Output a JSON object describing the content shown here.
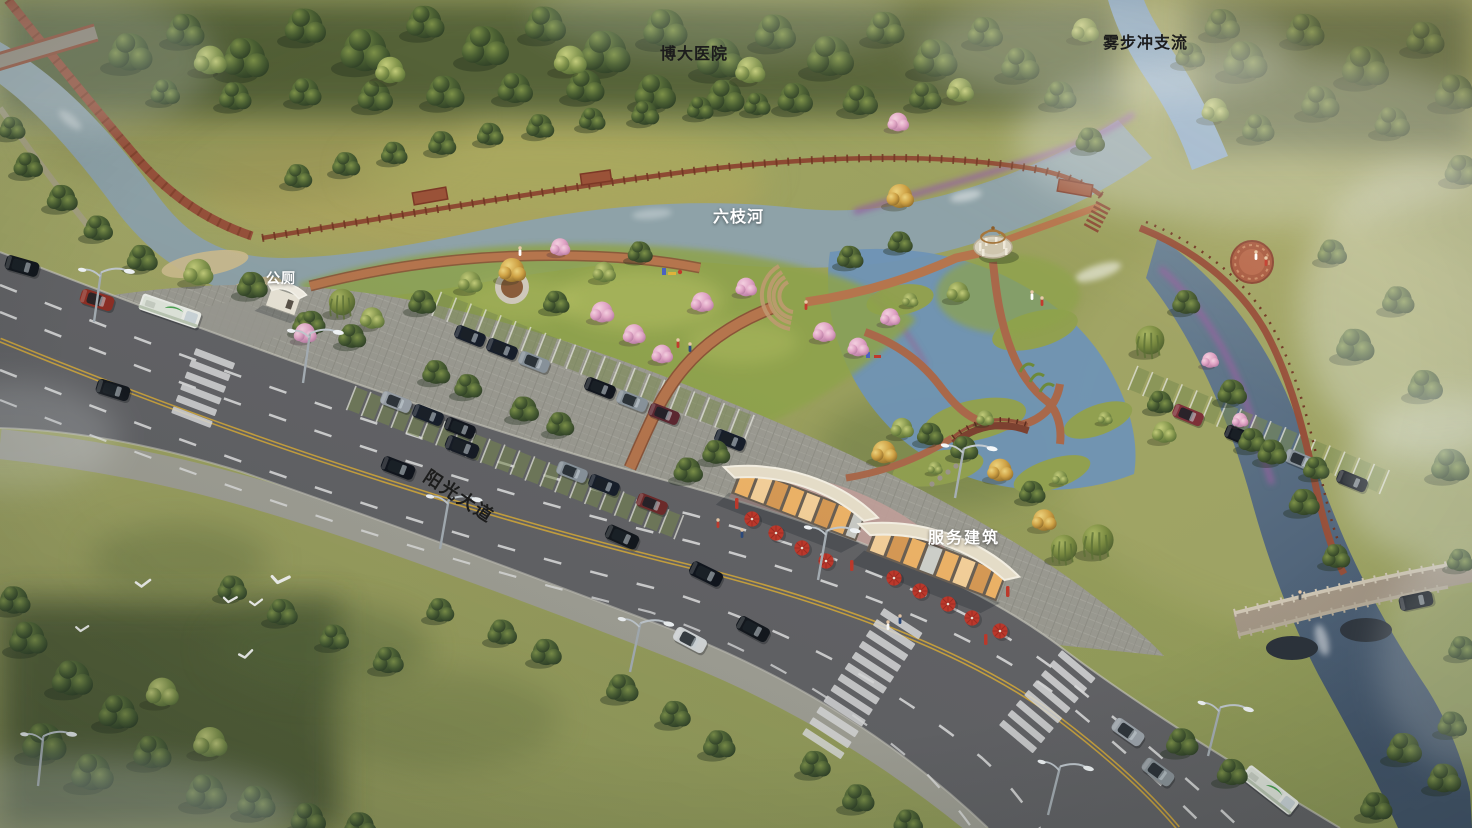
{
  "scene": {
    "type": "aerial-perspective-rendering",
    "labels": {
      "hospital": "博大医院",
      "tributary": "雾步冲支流",
      "river": "六枝河",
      "public_toilet": "公厕",
      "avenue": "阳光大道",
      "service_building": "服务建筑"
    },
    "palette": {
      "label_dark": "#1c1c1c",
      "label_light": "#ffffff",
      "grass": "#9ba464",
      "forest_green": "#46582f",
      "canal_water": "#8ea2a8",
      "river_water": "#6f93b5",
      "road_asphalt": "#636366",
      "paving": "#9b9a91",
      "brick_path": "#b0724e",
      "boardwalk_red": "#8d4a33",
      "umbrella_red": "#c0382b",
      "building_wall": "#e6dcc6",
      "blossom_pink": "#dfa3c4",
      "flower_purple": "#93639f"
    }
  }
}
